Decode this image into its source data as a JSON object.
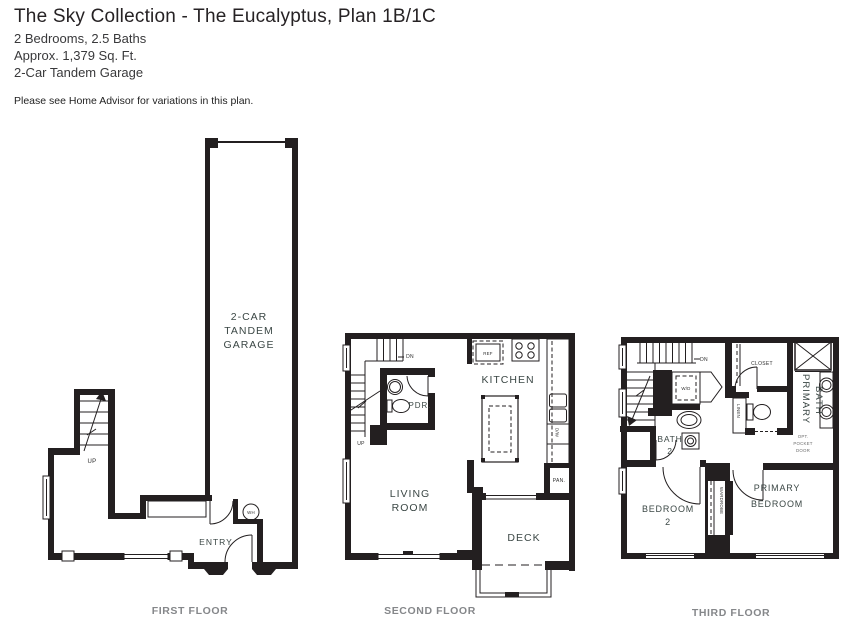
{
  "header": {
    "title": "The Sky Collection - The Eucalyptus, Plan 1B/1C",
    "spec_bedrooms_baths": "2 Bedrooms, 2.5 Baths",
    "spec_sqft": "Approx. 1,379 Sq. Ft.",
    "spec_garage": "2-Car Tandem Garage",
    "note": "Please see Home Advisor for variations in this plan."
  },
  "colors": {
    "wall": "#231f20",
    "room_label": "#3b4745",
    "caption": "#85878a"
  },
  "floors": {
    "first": {
      "caption": "FIRST FLOOR",
      "garage": [
        "2-CAR",
        "TANDEM",
        "GARAGE"
      ],
      "up": "UP",
      "entry": "ENTRY",
      "water_heater": "WH"
    },
    "second": {
      "caption": "SECOND FLOOR",
      "dn": "DN",
      "up": "UP",
      "powder": "PDR.",
      "kitchen": "KITCHEN",
      "refrigerator": "REF",
      "dishwasher": "D/W",
      "pantry": "PAN.",
      "living": [
        "LIVING",
        "ROOM"
      ],
      "deck": "DECK"
    },
    "third": {
      "caption": "THIRD FLOOR",
      "dn": "DN",
      "washer_dryer": "W/D",
      "closet": "CLOSET",
      "linen": "LINEN",
      "bath2": [
        "BATH",
        "2"
      ],
      "primary_bath": [
        "PRIMARY",
        "BATH"
      ],
      "pocket_door": [
        "OPT.",
        "POCKET",
        "DOOR"
      ],
      "bedroom2": [
        "BEDROOM",
        "2"
      ],
      "wardrobe": "WARDROBE",
      "primary_bedroom": [
        "PRIMARY",
        "BEDROOM"
      ]
    }
  }
}
